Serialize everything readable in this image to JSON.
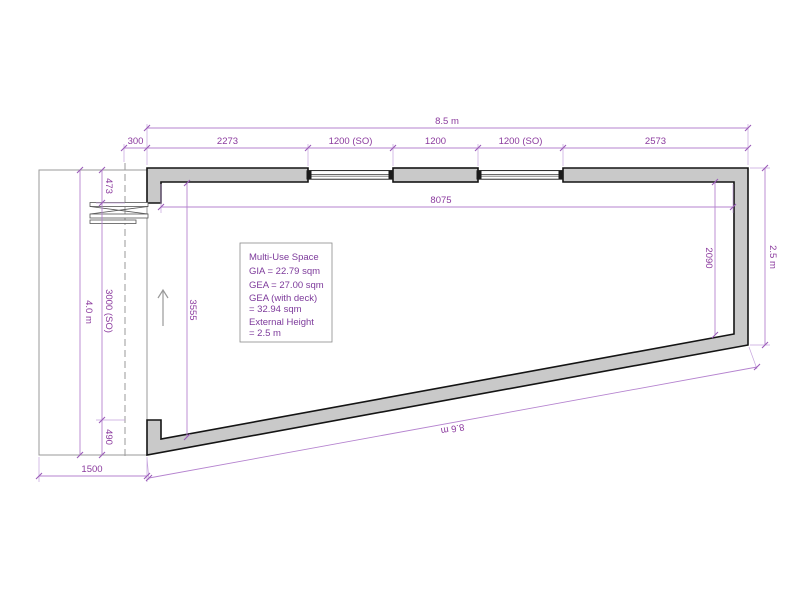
{
  "drawing": {
    "space_label": "Multi-Use Space",
    "info_box": {
      "lines": [
        "Multi-Use Space",
        "GIA = 22.79 sqm",
        "GEA = 27.00 sqm",
        "GEA (with deck)",
        "= 32.94 sqm",
        "External Height",
        "= 2.5 m"
      ]
    },
    "dims": {
      "overall_width": "8.5 m",
      "top_row": [
        "300",
        "2273",
        "1200 (SO)",
        "1200",
        "1200 (SO)",
        "2573"
      ],
      "interior_width": "8075",
      "right_overall": "2.5 m",
      "right_interior": "2090",
      "left_overall": "4.0 m",
      "left_row": [
        "473",
        "3000 (SO)",
        "490"
      ],
      "left_interior": "3555",
      "deck_width": "1500",
      "bottom_edge": "8.6 m"
    },
    "colors": {
      "dimension_text": "#8b3a9e",
      "dimension_line": "#b583cf",
      "wall_fill": "#c9c9c9",
      "wall_stroke": "#141414"
    }
  }
}
